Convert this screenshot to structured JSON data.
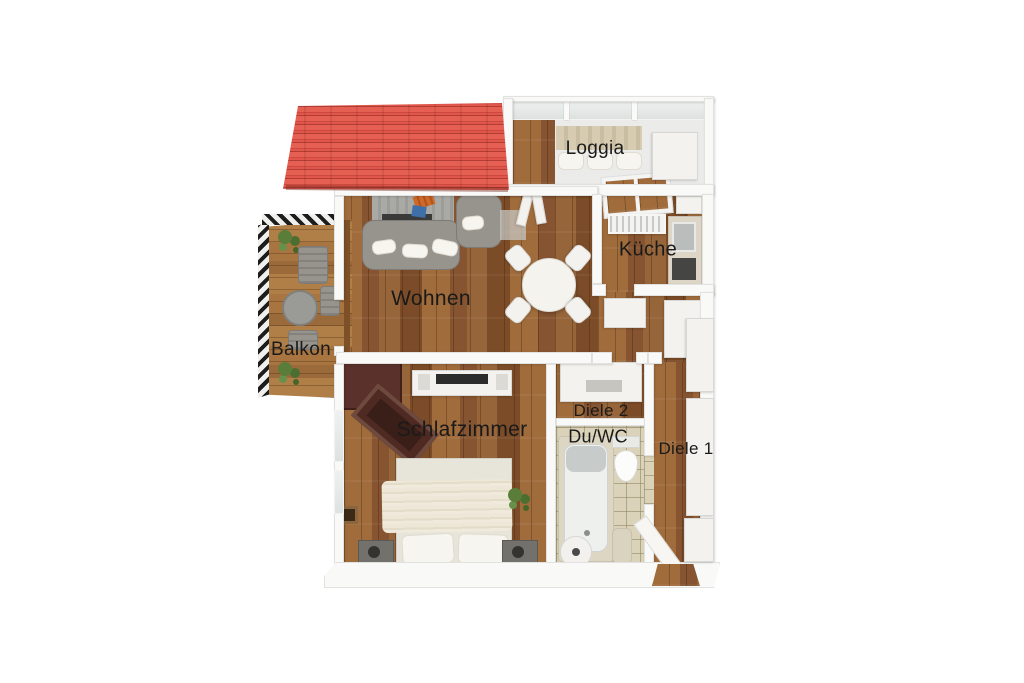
{
  "plan": {
    "type": "3d-floor-plan",
    "rooms": [
      {
        "id": "loggia",
        "label": "Loggia"
      },
      {
        "id": "kueche",
        "label": "Küche"
      },
      {
        "id": "wohnen",
        "label": "Wohnen"
      },
      {
        "id": "balkon",
        "label": "Balkon"
      },
      {
        "id": "schlafzimmer",
        "label": "Schlafzimmer"
      },
      {
        "id": "diele-2",
        "label": "Diele 2"
      },
      {
        "id": "du-wc",
        "label": "Du/WC"
      },
      {
        "id": "diele-1",
        "label": "Diele 1"
      }
    ],
    "furniture": [
      "roof",
      "balcony-railing",
      "balcony-table",
      "balcony-chairs",
      "potted-plants",
      "corner-sofa",
      "armchair",
      "rug",
      "tv-board",
      "dining-table",
      "dining-chairs",
      "loggia-glazing",
      "loggia-bench",
      "kitchen-window",
      "radiator",
      "kitchen-counter",
      "sink",
      "oven",
      "wardrobe",
      "sideboard-tv",
      "double-bed",
      "nightstands",
      "bedroom-plant",
      "hall-cabinet",
      "bathtub",
      "toilet",
      "washbasin",
      "towel-unit",
      "entrance-door"
    ],
    "colors": {
      "background": "#ffffff",
      "roof_red": "#e2594e",
      "wood_floor": "#96653a",
      "balcony_deck": "#a87a45",
      "wall_white": "#f9f9f8",
      "tile_beige": "#dad3b9",
      "sofa_gray": "#97948e",
      "wardrobe_brown": "#55302a",
      "plant_green": "#5a7d3a",
      "label_text": "#1a1a1a"
    }
  }
}
